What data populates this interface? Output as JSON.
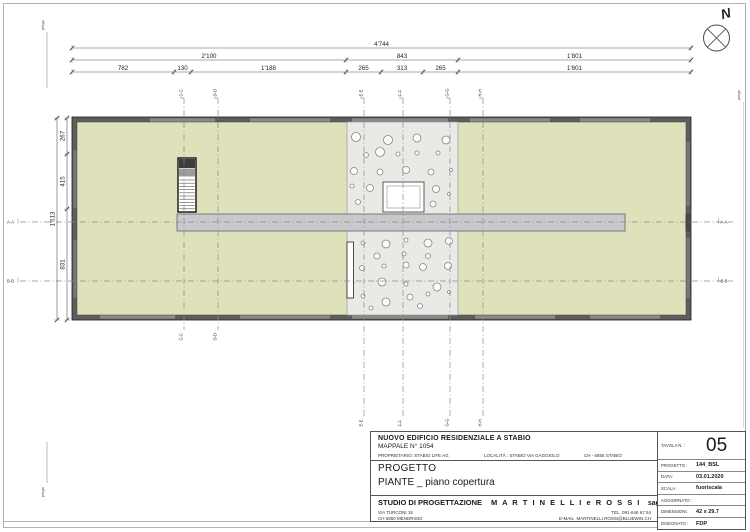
{
  "sheet": {
    "background": "#ffffff",
    "border_color": "#b2b2b2"
  },
  "north": {
    "label": "N"
  },
  "fold_marks": {
    "label": "piega"
  },
  "plan": {
    "roof_color": "#dfe1ba",
    "wall_color": "#5e5e5e",
    "gravel_color": "#e9e9e6",
    "walkway_color": "#c9c9cd",
    "pebbles": [
      [
        356,
        137,
        4.5
      ],
      [
        388,
        140,
        4.5
      ],
      [
        417,
        138,
        4
      ],
      [
        446,
        140,
        4
      ],
      [
        366,
        155,
        2.5
      ],
      [
        380,
        152,
        4.5
      ],
      [
        398,
        154,
        2
      ],
      [
        417,
        153,
        2
      ],
      [
        438,
        153,
        2
      ],
      [
        354,
        171,
        3.5
      ],
      [
        380,
        172,
        3
      ],
      [
        406,
        170,
        3.5
      ],
      [
        431,
        172,
        3
      ],
      [
        451,
        170,
        1.5
      ],
      [
        352,
        186,
        2
      ],
      [
        370,
        188,
        3.5
      ],
      [
        436,
        189,
        3.5
      ],
      [
        449,
        194,
        1.5
      ],
      [
        358,
        202,
        2.5
      ],
      [
        433,
        204,
        3
      ],
      [
        363,
        243,
        2
      ],
      [
        386,
        244,
        4
      ],
      [
        406,
        240,
        2
      ],
      [
        428,
        243,
        4
      ],
      [
        449,
        241,
        3.5
      ],
      [
        377,
        256,
        3
      ],
      [
        404,
        254,
        2
      ],
      [
        428,
        256,
        2.5
      ],
      [
        362,
        268,
        2.5
      ],
      [
        384,
        266,
        2
      ],
      [
        406,
        265,
        3
      ],
      [
        423,
        267,
        3.5
      ],
      [
        448,
        266,
        3.5
      ],
      [
        352,
        283,
        2
      ],
      [
        382,
        282,
        4
      ],
      [
        406,
        284,
        2
      ],
      [
        437,
        287,
        4
      ],
      [
        363,
        296,
        2
      ],
      [
        386,
        302,
        4
      ],
      [
        410,
        297,
        3
      ],
      [
        428,
        294,
        2
      ],
      [
        449,
        292,
        1.5
      ],
      [
        371,
        308,
        2
      ],
      [
        420,
        306,
        2.5
      ]
    ]
  },
  "dimensions": {
    "top": {
      "row1": {
        "labels": [
          "4'744"
        ]
      },
      "row2": {
        "labels": [
          "2'100",
          "843",
          "1'801"
        ]
      },
      "row3": {
        "labels": [
          "782",
          "130",
          "1'188",
          "265",
          "313",
          "265",
          "1'801"
        ]
      }
    },
    "left": {
      "total": [
        "1'513"
      ],
      "segments": [
        "267",
        "415",
        "831"
      ]
    }
  },
  "sections": {
    "vertical": [
      "C-C",
      "D-D",
      "E-E",
      "F-F",
      "G-G",
      "H-H"
    ],
    "horizontal": [
      "A-A",
      "B-B"
    ]
  },
  "title_block": {
    "project_title": "NUOVO EDIFICIO RESIDENZIALE A STABIO",
    "parcel": "MAPPALE N° 1054",
    "owner": "PROPRIETARIO: STABIO LIFE AG",
    "locality": "LOCALITÀ : STABIO VIA GAGGIOLO",
    "place": "CH - 6855 STABIO",
    "progetto_label": "PROGETTO",
    "drawing_title": "PIANTE _ piano copertura",
    "studio_label": "STUDIO DI PROGETTAZIONE",
    "studio_name": "M A R T I N E L L I  e  R O S S I",
    "studio_suffix": "sagl",
    "address1": "VIA TURCONI 15",
    "address2": "CH 6850 MENDRISIO",
    "phone": "TEL. 091-646 67 54",
    "email_label": "E-MAIL",
    "email": "MARTINELLI.ROSSI@BLUEWIN.CH",
    "fields": [
      {
        "label": "TAVOLA N. :",
        "value": "05"
      },
      {
        "label": "PROGETTO :",
        "value": "144_BSL"
      },
      {
        "label": "DATA:",
        "value": "03.01.2020"
      },
      {
        "label": "SCALA :",
        "value": "fuoriscala"
      },
      {
        "label": "AGGIORNATO :",
        "value": ""
      },
      {
        "label": "DIMENSIONI:",
        "value": "42 x 29.7"
      },
      {
        "label": "DISEGNATO :",
        "value": "FDP"
      }
    ]
  }
}
